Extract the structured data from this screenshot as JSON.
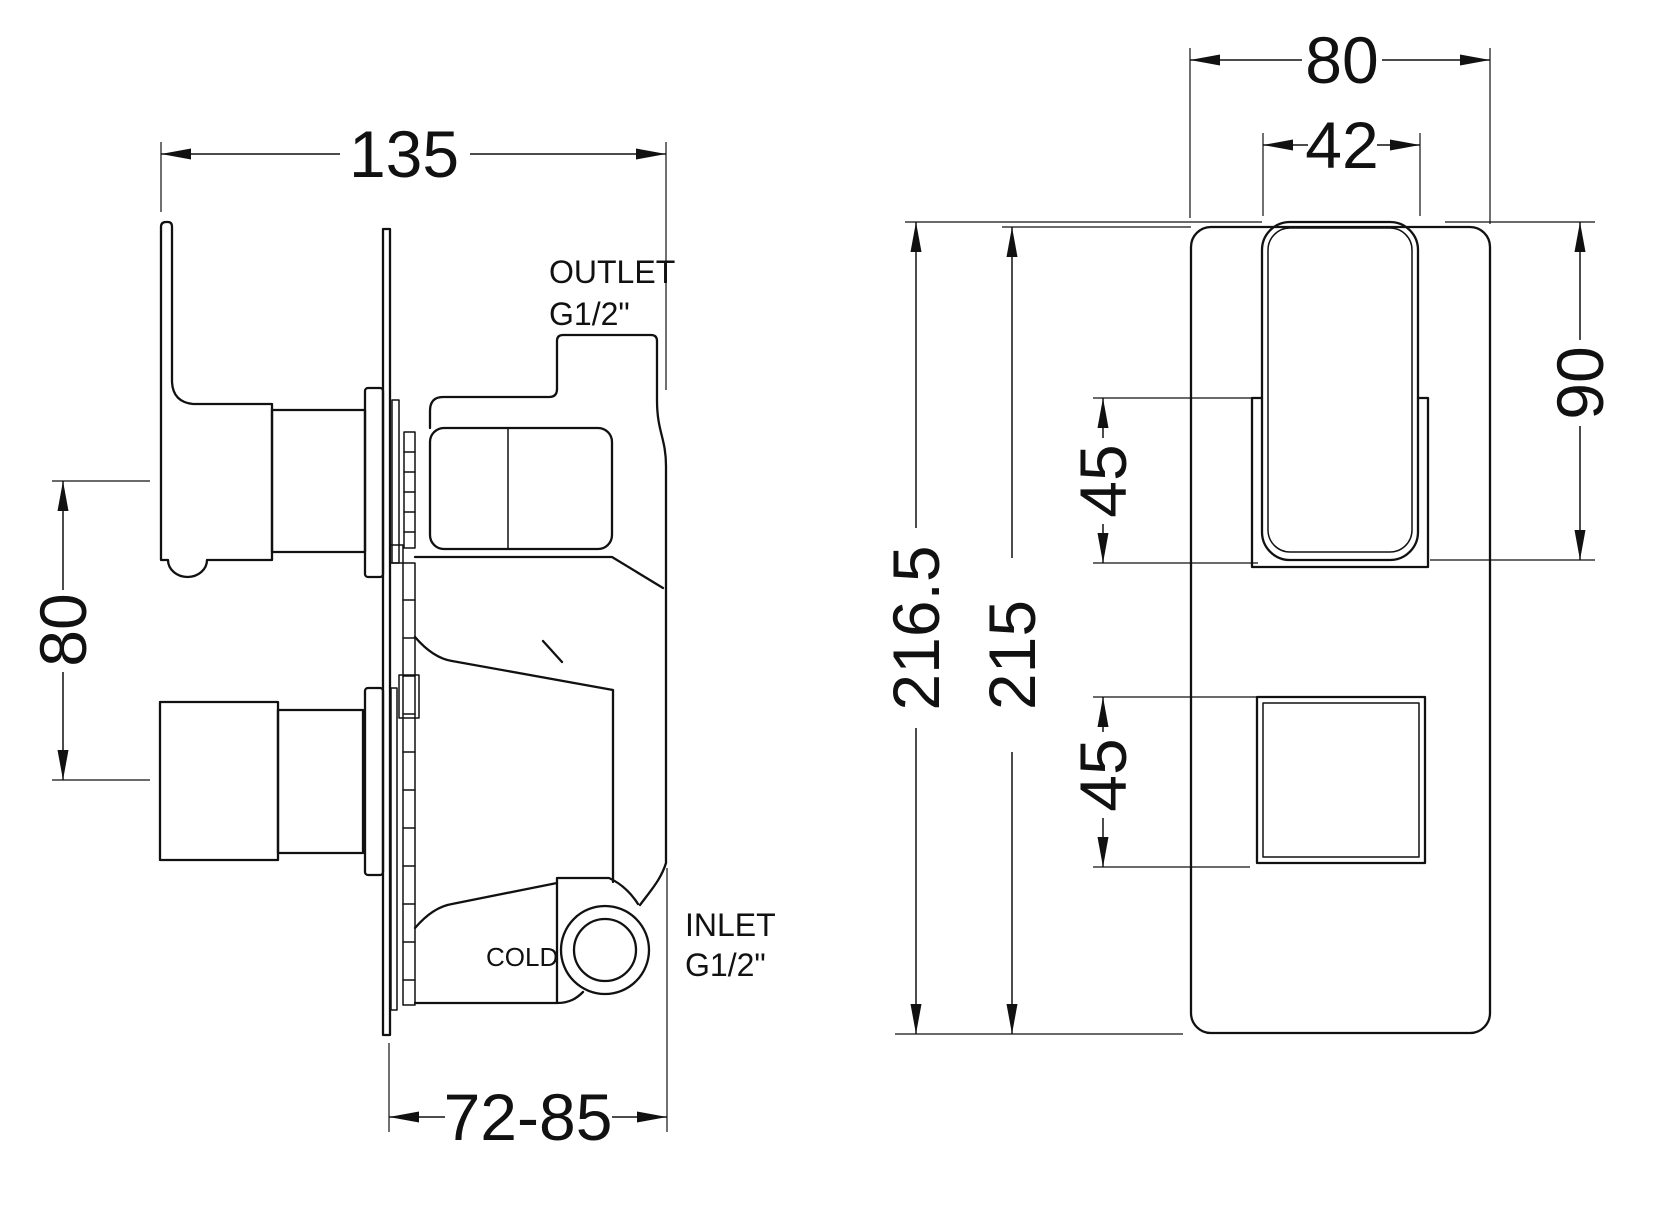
{
  "title": "Concealed thermostatic shower valve dimension drawing",
  "colors": {
    "line": "#111111",
    "background": "#ffffff"
  },
  "side_view": {
    "dim_width": "135",
    "dim_handle_spacing": "80",
    "dim_wall_depth": "72-85",
    "label_outlet": "OUTLET",
    "label_outlet_thread": "G1/2\"",
    "label_inlet": "INLET",
    "label_inlet_thread": "G1/2\"",
    "label_cold": "COLD"
  },
  "front_view": {
    "dim_plate_width": "80",
    "dim_handle_width": "42",
    "dim_handle_height": "90",
    "dim_upper_handle_section": "45",
    "dim_lower_handle_section": "45",
    "dim_overall_height": "216.5",
    "dim_plate_height": "215"
  }
}
